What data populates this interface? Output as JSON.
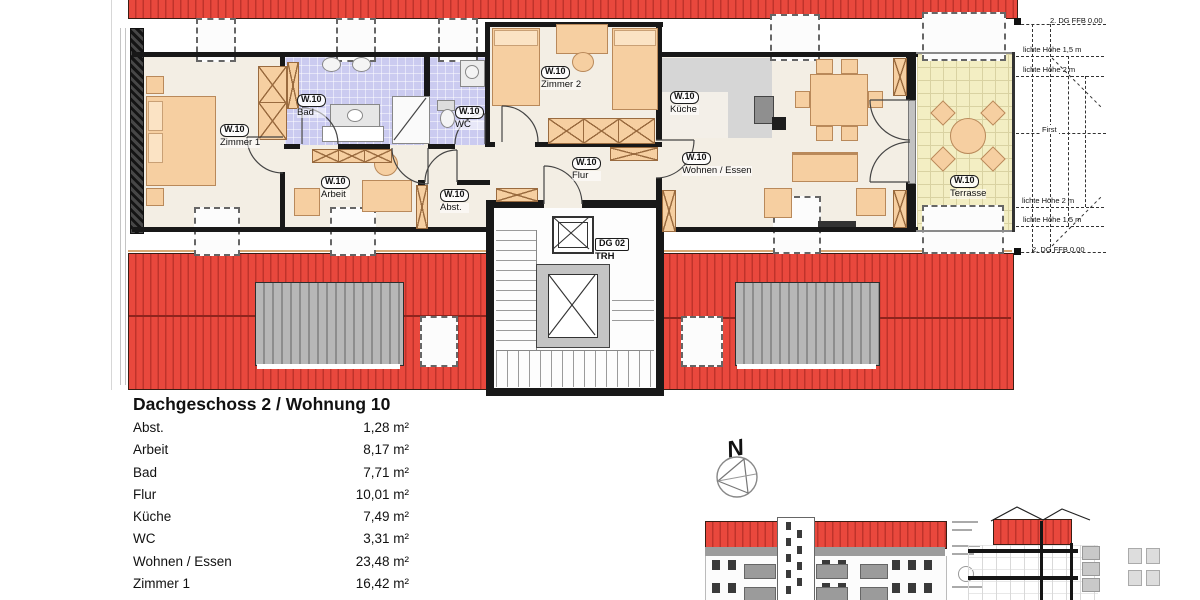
{
  "title": "Dachgeschoss 2 / Wohnung 10",
  "plan": {
    "unit": "W.10",
    "rooms": [
      {
        "tag": "W.10",
        "name": "Zimmer 1"
      },
      {
        "tag": "W.10",
        "name": "Bad"
      },
      {
        "tag": "W.10",
        "name": "WC"
      },
      {
        "tag": "W.10",
        "name": "Zimmer 2"
      },
      {
        "tag": "W.10",
        "name": "Küche"
      },
      {
        "tag": "W.10",
        "name": "Wohnen / Essen"
      },
      {
        "tag": "W.10",
        "name": "Flur"
      },
      {
        "tag": "W.10",
        "name": "Arbeit"
      },
      {
        "tag": "W.10",
        "name": "Abst."
      },
      {
        "tag": "W.10",
        "name": "Terrasse"
      }
    ],
    "stairwell": {
      "tag": "DG 02",
      "name": "TRH"
    },
    "north_label": "N",
    "annotations": [
      "2. DG  FFB 0,00",
      "lichte Höhe 1,5 m",
      "lichte Höhe 2 m",
      "First",
      "lichte Höhe 2 m",
      "lichte Höhe 1,5 m",
      "2. DG  FFB 0,00"
    ]
  },
  "area_table": {
    "heading": "Dachgeschoss 2 / Wohnung 10",
    "rows": [
      {
        "room": "Abst.",
        "area": "1,28 m²"
      },
      {
        "room": "Arbeit",
        "area": "8,17 m²"
      },
      {
        "room": "Bad",
        "area": "7,71 m²"
      },
      {
        "room": "Flur",
        "area": "10,01 m²"
      },
      {
        "room": "Küche",
        "area": "7,49 m²"
      },
      {
        "room": "WC",
        "area": "3,31 m²"
      },
      {
        "room": "Wohnen / Essen",
        "area": "23,48 m²"
      },
      {
        "room": "Zimmer 1",
        "area": "16,42 m²"
      }
    ]
  },
  "colors": {
    "roof_red": "#e9483d",
    "roof_stripe": "#bf332b",
    "tile_lavender": "#cbcbf0",
    "terrace_yellow": "#f3eec3",
    "furniture_tan": "#f6cfa1",
    "wall_black": "#181818",
    "counter_grey": "#d6d6d6",
    "dormer_grey": "#b0b0b0"
  }
}
